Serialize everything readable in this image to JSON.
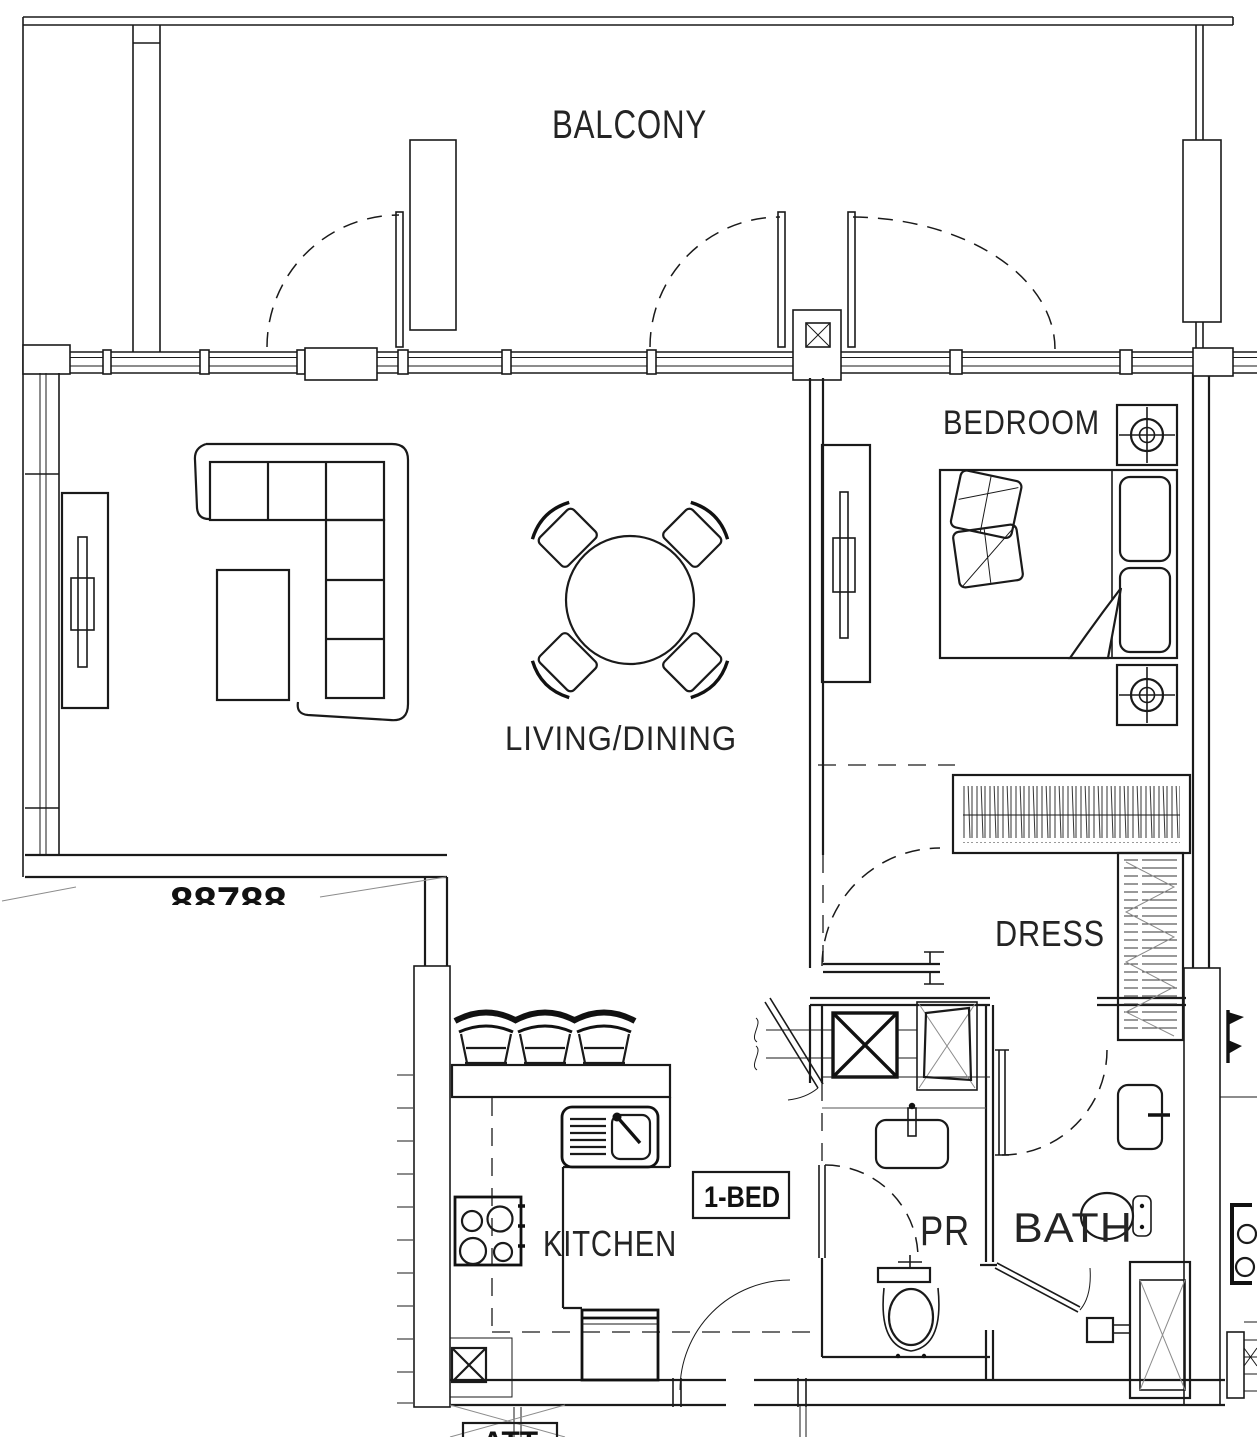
{
  "unit": {
    "type_label": "1-BED"
  },
  "plan": {
    "rooms": {
      "balcony": "BALCONY",
      "living_dining": "LIVING/DINING",
      "bedroom": "BEDROOM",
      "dress": "DRESS",
      "kitchen": "KITCHEN",
      "powder_room": "PR",
      "bath": "BATH"
    }
  },
  "clipped": {
    "neighbor_partial_text": "88788",
    "bottom_partial_text": "ATT"
  },
  "colors": {
    "line": "#1a1a1a",
    "background": "#ffffff",
    "hatch": "#1c1c1c",
    "faint": "#8c8c8c"
  },
  "symbols": {
    "sofa": "sectional-sofa",
    "coffee_table": "coffee-table",
    "tv": "tv-panel",
    "dining": "round-dining-table-4-chairs",
    "stool": "bar-stool",
    "bed": "double-bed",
    "nightstand": "nightstand-downlight",
    "wardrobe_hang": "wardrobe-hanging-rail",
    "wardrobe_shelf": "wardrobe-shelves",
    "sink": "kitchen-sink",
    "cooktop": "cooktop-4-burner",
    "fridge": "refrigerator",
    "basin": "washbasin",
    "toilet": "toilet",
    "shower": "shower-enclosure",
    "heater": "water-heater",
    "shaft": "duct-shaft",
    "door": "door-swing",
    "column": "crosshatched-column",
    "window": "glazed-window-wall"
  }
}
